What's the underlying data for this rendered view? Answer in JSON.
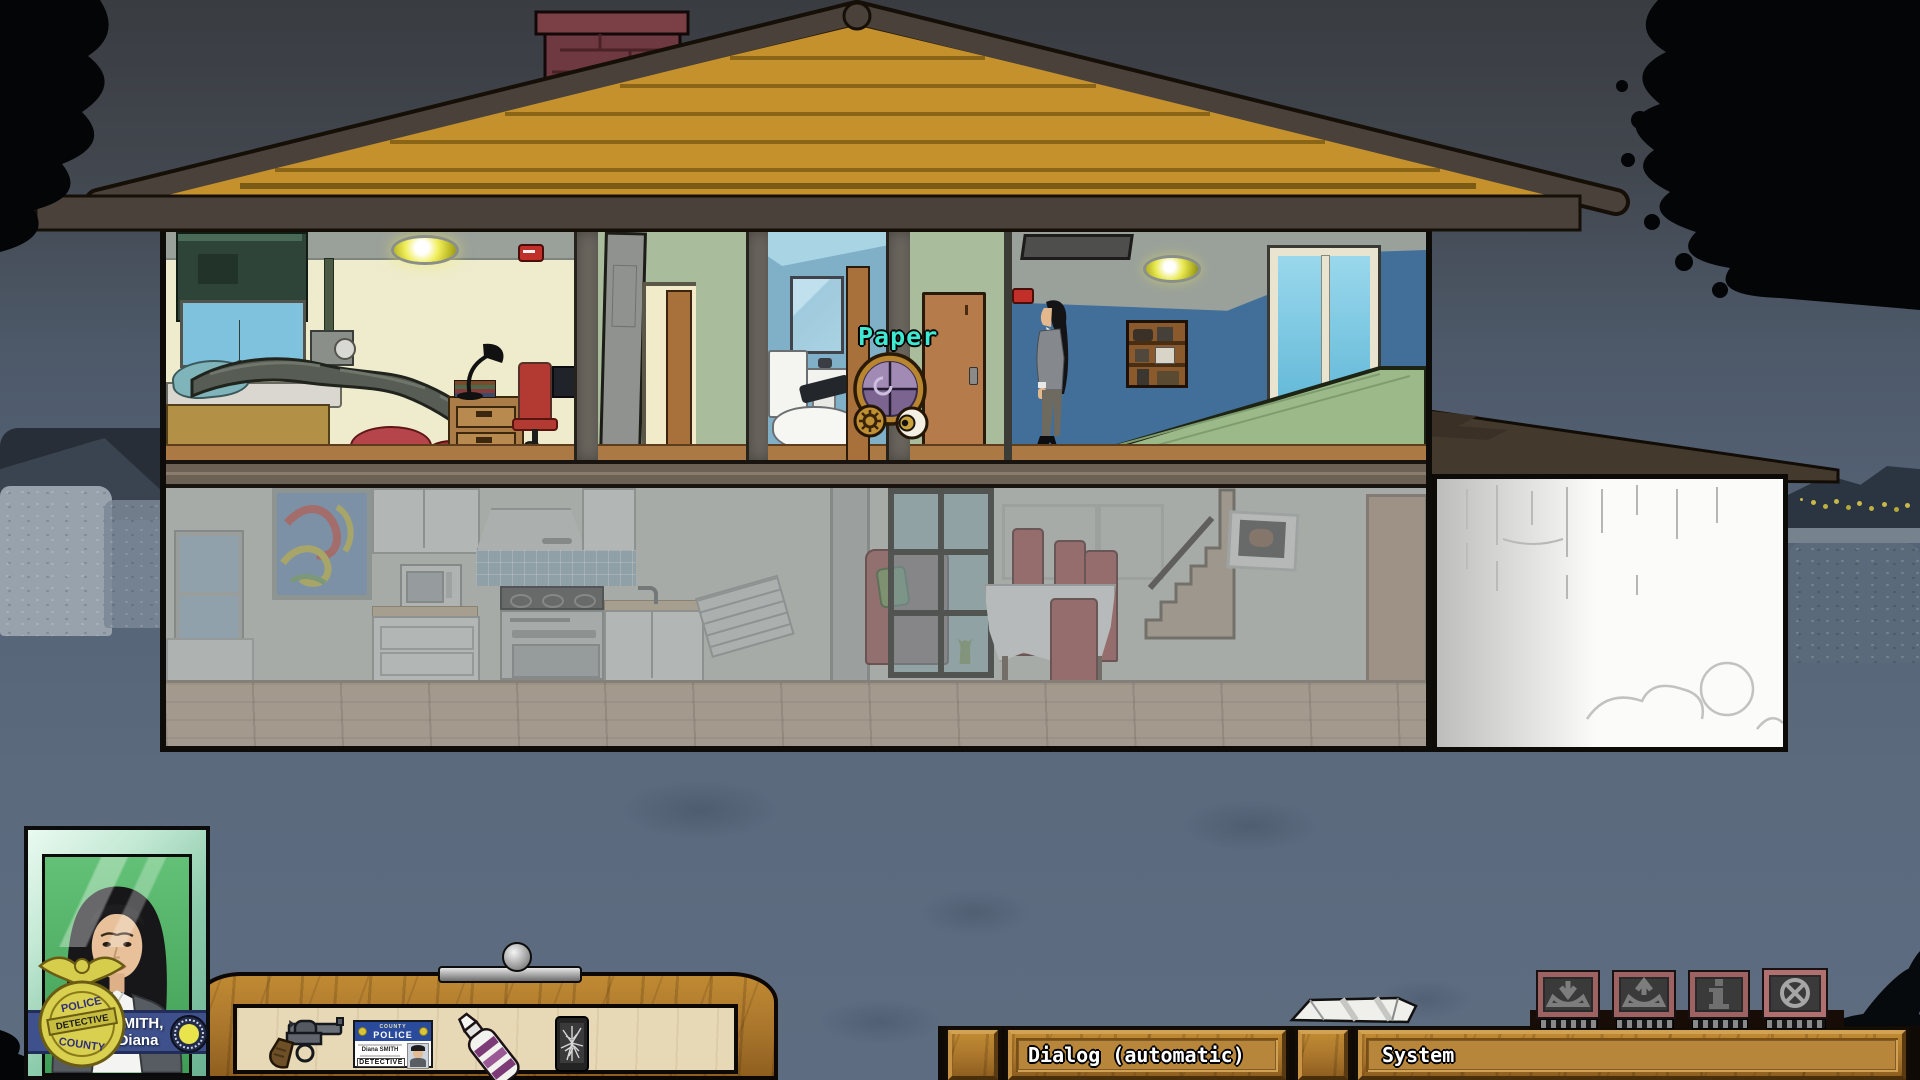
{
  "scene": {
    "hover_label": "Paper",
    "hover_label_color": "#3fe8d0",
    "hovered_hotspot": "Paper"
  },
  "hud": {
    "portrait": {
      "name_line1": "SMITH,",
      "name_line2": "Diana",
      "badge": {
        "top": "POLICE",
        "mid": "DETECTIVE",
        "bottom": "COUNTY"
      }
    },
    "inventory": {
      "items": [
        {
          "id": "revolver"
        },
        {
          "id": "police-id-card"
        },
        {
          "id": "glue-bottle"
        },
        {
          "id": "cracked-phone"
        }
      ],
      "id_card": {
        "county": "COUNTY",
        "police": "POLICE",
        "holder": "Diana SMITH",
        "role": "DETECTIVE"
      }
    },
    "menu_buttons": [
      {
        "id": "save",
        "icon": "save-download-icon"
      },
      {
        "id": "load",
        "icon": "load-upload-icon"
      },
      {
        "id": "info",
        "icon": "info-icon"
      },
      {
        "id": "quit",
        "icon": "quit-close-icon"
      }
    ],
    "bars": {
      "dialog_label": "Dialog (automatic)",
      "system_label": "System"
    }
  },
  "colors": {
    "wood": "#ad7a28",
    "tray_panel": "#e7d9b6",
    "banner_blue": "#3f518c",
    "photo_green": "#55bd69",
    "roof_gable": "#c5912d",
    "night_sky": "#42474f"
  }
}
